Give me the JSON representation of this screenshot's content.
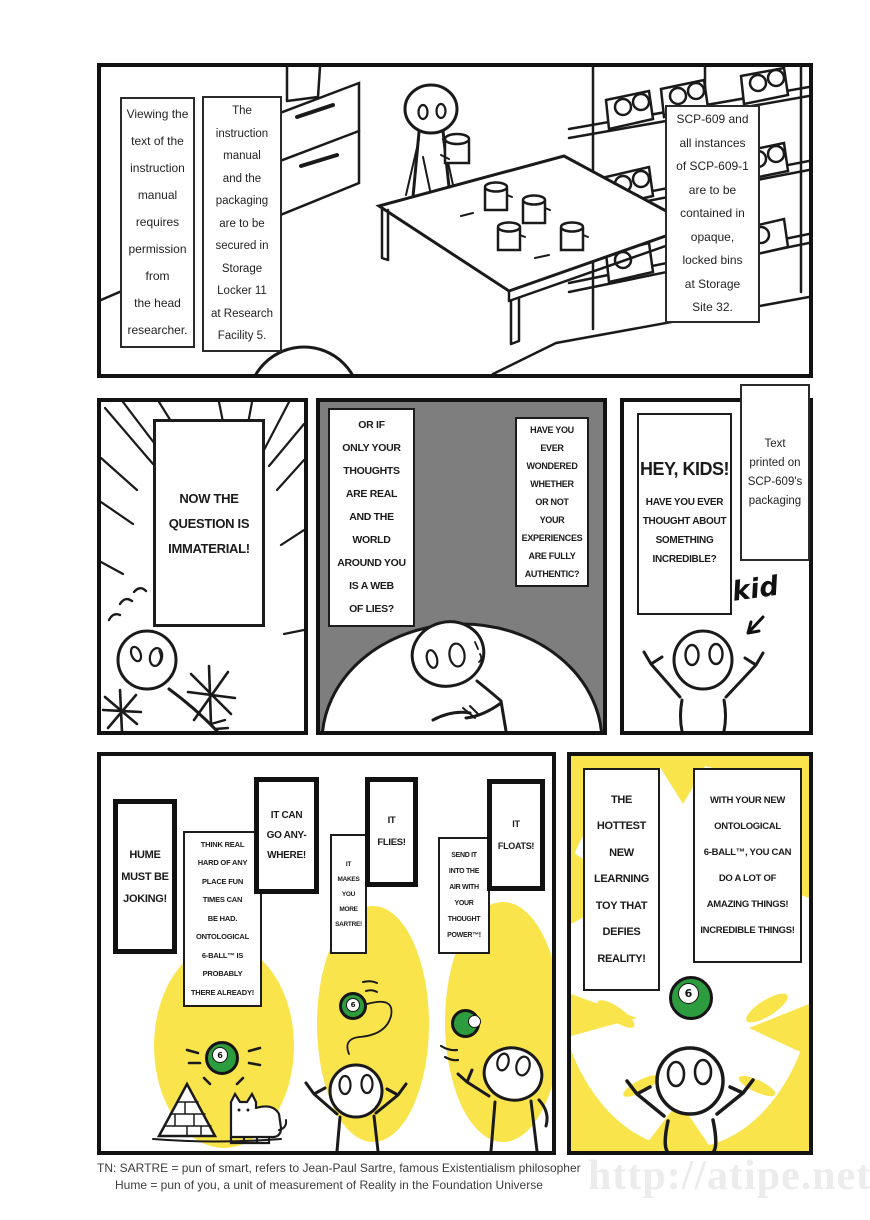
{
  "colors": {
    "yellow": "#FAE44C",
    "green": "#2D9C3E",
    "panel_gray": "#7E7E7E",
    "ink": "#1A1A1A",
    "watermark_gray": "#ECECEC"
  },
  "ball": {
    "number": "6"
  },
  "panels": {
    "containment": {
      "caption_left": "Viewing the\ntext of the\ninstruction\nmanual\nrequires\npermission\nfrom\nthe head\nresearcher.",
      "caption_center": "The\ninstruction\nmanual\nand the\npackaging\nare to be\nsecured in\nStorage\nLocker 11\nat Research\nFacility 5.",
      "caption_right": "SCP-609 and\nall instances\nof SCP-609-1\nare to be\ncontained in\nopaque,\nlocked bins\nat Storage\nSite 32."
    },
    "immaterial": {
      "speech": "NOW THE\nQUESTION IS\nIMMATERIAL!"
    },
    "doubt": {
      "speech_left": "OR IF\nONLY YOUR\nTHOUGHTS\nARE REAL\nAND THE\nWORLD\nAROUND YOU\nIS A WEB\nOF LIES?",
      "speech_right": "HAVE YOU\nEVER\nWONDERED\nWHETHER\nOR NOT\nYOUR\nEXPERIENCES\nARE FULLY\nAUTHENTIC?"
    },
    "hey_kids": {
      "title": "HEY, KIDS!",
      "body": "HAVE YOU EVER\nTHOUGHT ABOUT\nSOMETHING\nINCREDIBLE?",
      "caption": "Text\nprinted on\nSCP-609's\npackaging",
      "annotation": "kid"
    },
    "features": {
      "hume": "HUME\nMUST BE\nJOKING!",
      "think": "THINK REAL\nHARD OF ANY\nPLACE FUN\nTIMES CAN\nBE HAD.\nONTOLOGICAL\n6-BALL™ IS\nPROBABLY\nTHERE ALREADY!",
      "anywhere": "IT CAN\nGO ANY-\nWHERE!",
      "flies": "IT\nFLIES!",
      "sartre": "IT\nMAKES\nYOU\nMORE\nSARTRE!",
      "floats": "IT\nFLOATS!",
      "send": "SEND IT\nINTO THE\nAIR WITH\nYOUR\nTHOUGHT\nPOWER™!"
    },
    "advert": {
      "hottest": "THE\nHOTTEST\nNEW\nLEARNING\nTOY THAT\nDEFIES\nREALITY!",
      "with_your": "WITH YOUR NEW\nONTOLOGICAL\n6-BALL™, YOU CAN\nDO A LOT OF\nAMAZING THINGS!\nINCREDIBLE THINGS!"
    }
  },
  "footer": {
    "line1": "TN: SARTRE = pun of smart, refers to Jean-Paul Sartre, famous Existentialism philosopher",
    "line2": "Hume = pun of you, a unit of measurement of Reality in the Foundation Universe"
  },
  "watermark": "http://atipe.net/"
}
